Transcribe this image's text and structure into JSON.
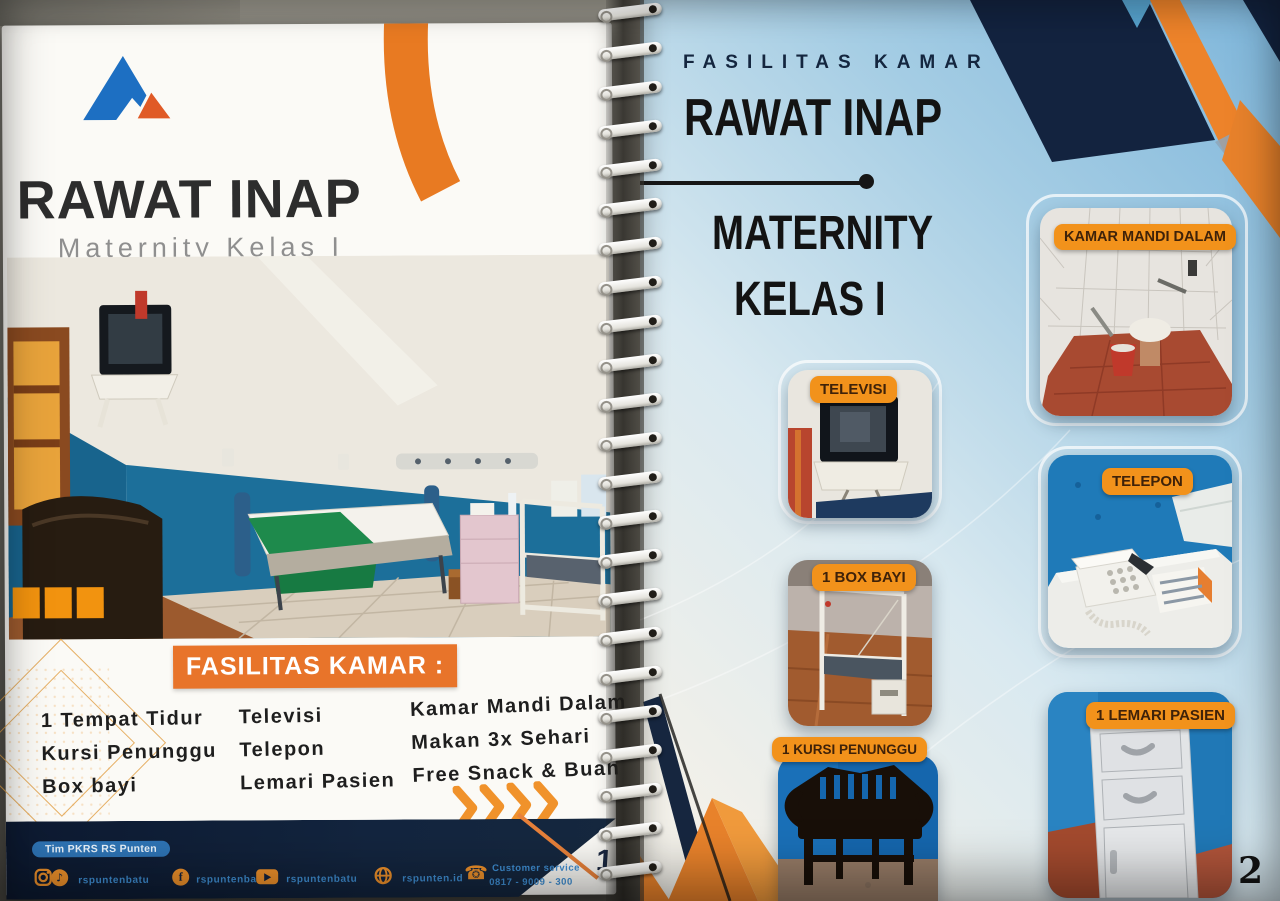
{
  "left_page": {
    "title": "RAWAT INAP",
    "subtitle": "Maternity Kelas I",
    "banner": "FASILITAS KAMAR :",
    "facilities": {
      "col1": [
        "1 Tempat Tidur",
        "Kursi Penunggu",
        "Box bayi"
      ],
      "col2": [
        "Televisi",
        "Telepon",
        "Lemari Pasien"
      ],
      "col3": [
        "Kamar Mandi Dalam",
        "Makan 3x Sehari",
        "Free Snack & Buah"
      ]
    },
    "footer": {
      "badge": "Tim PKRS RS Punten",
      "social_instagram_tiktok": "rspuntenbatu",
      "social_facebook": "rspuntenbatu",
      "social_youtube": "rspuntenbatu",
      "website": "rspunten.id",
      "customer_service_label": "Customer service",
      "customer_service_phone": "0817 - 9009 - 300",
      "page_number": "1"
    }
  },
  "right_page": {
    "eyebrow": "FASILITAS KAMAR",
    "title_line1": "RAWAT INAP",
    "title_line2": "MATERNITY",
    "title_line3": "KELAS I",
    "labels": {
      "kamar_mandi": "KAMAR MANDI DALAM",
      "televisi": "TELEVISI",
      "telepon": "TELEPON",
      "box_bayi": "1 BOX BAYI",
      "kursi_penunggu": "1 KURSI PENUNGGU",
      "lemari_pasien": "1 LEMARI PASIEN"
    },
    "page_number": "2"
  },
  "colors": {
    "orange": "#EE8023",
    "navy": "#13233F",
    "logo_blue": "#1D6FC2",
    "teal_wall": "#1C6F9A",
    "handle_blue": "#3F8FD4"
  }
}
